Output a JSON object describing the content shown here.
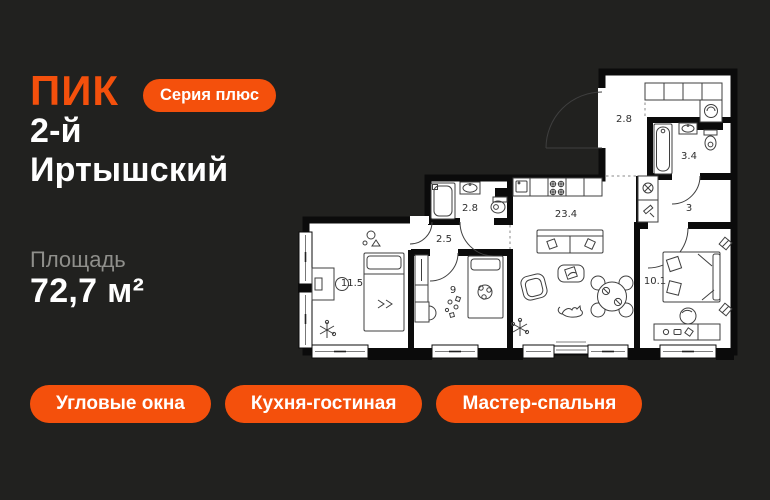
{
  "page": {
    "background": "#21211F",
    "accent": "#F4500C"
  },
  "brand": {
    "logo": "ПИК",
    "badge": "Серия плюс"
  },
  "title": {
    "line1": "2-й",
    "line2": "Иртышский"
  },
  "area": {
    "label": "Площадь",
    "value": "72,7 м²"
  },
  "tags": [
    "Угловые окна",
    "Кухня-гостиная",
    "Мастер-спальня"
  ],
  "floorplan": {
    "wall_color": "#0B0B0B",
    "floor_color": "#FFFFFF",
    "rooms": [
      {
        "id": "entry-hall",
        "area": "2.8"
      },
      {
        "id": "bathroom",
        "area": "3.4"
      },
      {
        "id": "corridor",
        "area": "3"
      },
      {
        "id": "shower-room",
        "area": "2.8"
      },
      {
        "id": "hallway",
        "area": "2.5"
      },
      {
        "id": "kitchen-living-room",
        "area": "23.4"
      },
      {
        "id": "bedroom",
        "area": "11.5"
      },
      {
        "id": "kids-bedroom",
        "area": "9"
      },
      {
        "id": "master-bedroom",
        "area": "10.1"
      }
    ]
  }
}
